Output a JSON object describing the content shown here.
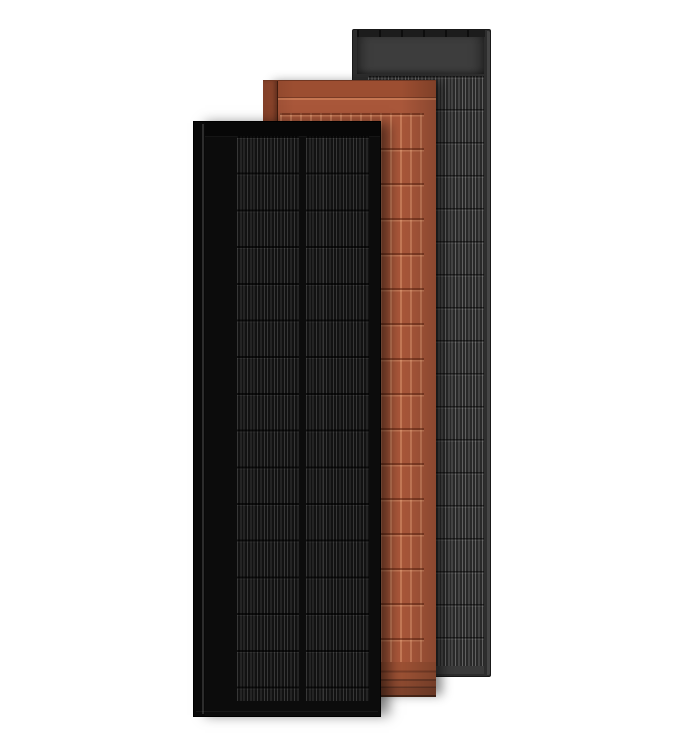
{
  "scene": {
    "description": "Product render of three overlapping vertical solar panels on a white background",
    "panel_count": 3
  },
  "colors": {
    "bg": "#ffffff",
    "gray-face": "#2d2d2d",
    "gray-bezel": "#4a4a4a",
    "gray-rail": "#1c1c1c",
    "gray-header": "#3d3d3d",
    "gray-cells-bg": "#292929",
    "gray-bottom": "#3a3a3a",
    "terra-face": "#a9573a",
    "terra-top-band": "#9c4e31",
    "terra-rail": "#95492e",
    "black-face": "#0c0c0c",
    "black-rail": "#090909",
    "black-cells-bg": "#121212"
  },
  "panels": [
    {
      "id": "gray",
      "label": "",
      "position": "back",
      "finish_color": "#2d2d2d",
      "features": [
        "dark top rail",
        "plain gray header block",
        "fine vertical cell striping",
        "light gray right bezel"
      ]
    },
    {
      "id": "terracotta",
      "label": "",
      "position": "middle",
      "finish_color": "#a9573a",
      "features": [
        "dark top band",
        "vertical tile ribs in rows",
        "stacked layered bottom edge",
        "dark left rail"
      ]
    },
    {
      "id": "black",
      "label": "",
      "position": "front",
      "finish_color": "#0c0c0c",
      "features": [
        "black frame with left rail highlight",
        "two columns of finely striped solar cells",
        "horizontal cell row separators"
      ]
    }
  ]
}
